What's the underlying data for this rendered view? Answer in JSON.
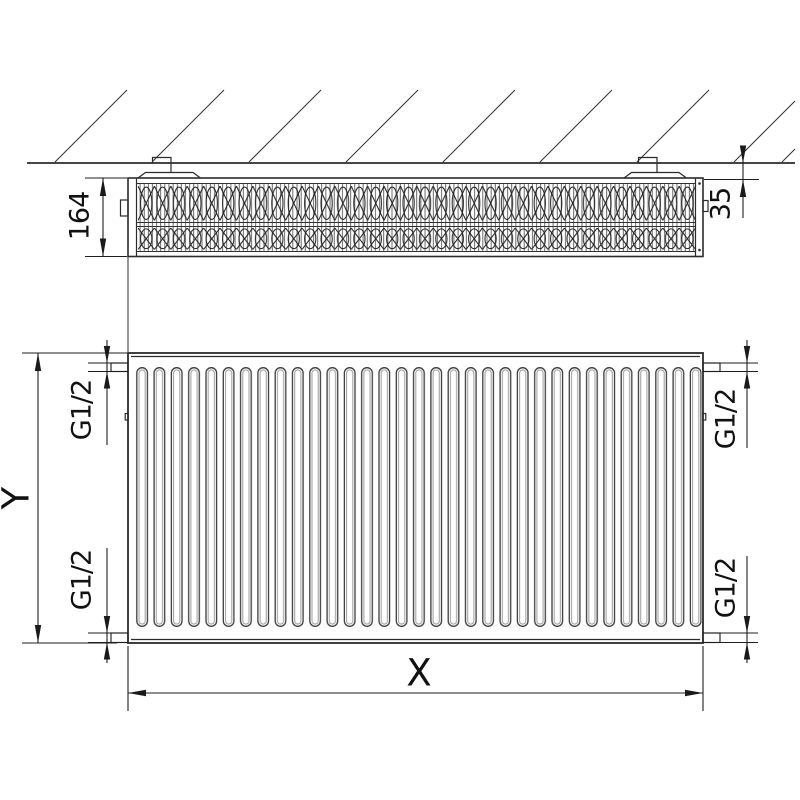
{
  "drawing": {
    "kind": "panel-radiator-dimension-drawing",
    "views": {
      "top_view_name": "plan-section-at-wall",
      "front_view_name": "front-elevation"
    }
  },
  "top_view": {
    "depth_label": "164",
    "wall_clearance_label": "35"
  },
  "front_view": {
    "width_label": "X",
    "height_label": "Y",
    "connection_label": "G1/2"
  },
  "colors": {
    "line": "#2b2b2b",
    "dim_line": "#1f1f1f",
    "groove_shade": "#a6a6a6",
    "background": "#ffffff"
  }
}
